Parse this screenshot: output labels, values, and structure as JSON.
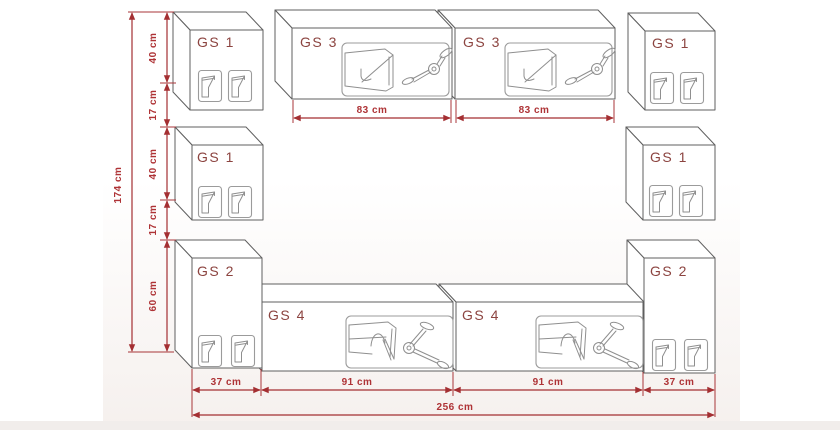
{
  "diagram_type": "furniture-wall-unit-dimension-drawing",
  "cabinets": {
    "top_left": {
      "label": "GS 1"
    },
    "mid_left": {
      "label": "GS 1"
    },
    "bottom_left": {
      "label": "GS 2"
    },
    "top_center_left": {
      "label": "GS 3"
    },
    "top_center_right": {
      "label": "GS 3"
    },
    "top_right": {
      "label": "GS 1"
    },
    "mid_right": {
      "label": "GS 1"
    },
    "bottom_right": {
      "label": "GS 2"
    },
    "bottom_center_left": {
      "label": "GS 4"
    },
    "bottom_center_right": {
      "label": "GS 4"
    }
  },
  "dimensions": {
    "height_total": "174 cm",
    "left_column": [
      "40 cm",
      "17 cm",
      "40 cm",
      "17 cm",
      "60 cm"
    ],
    "top_row": [
      "83 cm",
      "83 cm"
    ],
    "bottom_row": [
      "37 cm",
      "91 cm",
      "91 cm",
      "37 cm"
    ],
    "width_total": "256 cm"
  },
  "colors": {
    "dimension_red": "#a42f32",
    "dimension_text_red": "#ae3336",
    "cabinet_label_brown_red": "#8c4440",
    "cabinet_outline_gray": "#5f5f5f",
    "detail_gray": "#8f8f8f",
    "background": "#ffffff",
    "bottom_band": "#f1edeb"
  }
}
